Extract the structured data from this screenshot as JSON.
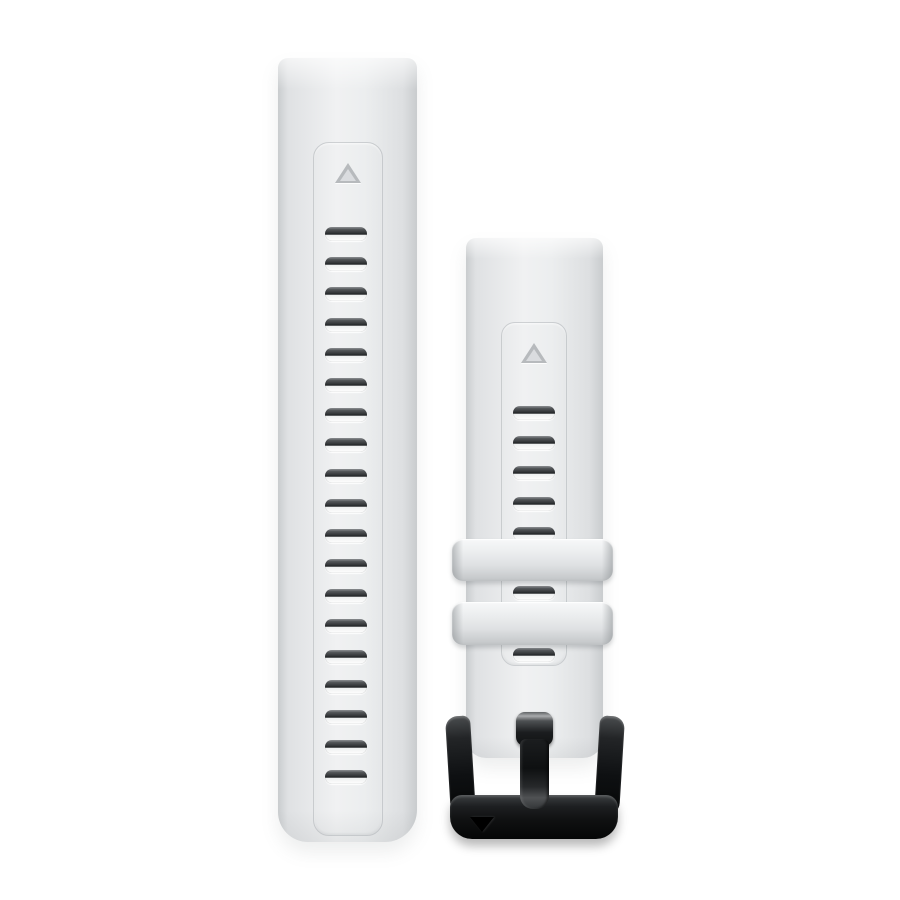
{
  "image": {
    "type": "product-photo",
    "subject": "Quick-release silicone watch band set: long adjustment strap and short strap with black buckle",
    "band_color_name": "whitestone",
    "background_color": "#ffffff"
  },
  "colors": {
    "background": "#ffffff",
    "band": "#e9ebec",
    "band_edge": "#c9ccce",
    "slot_dark": "#212426",
    "slot_light": "#ffffff",
    "marker": "#b7babd",
    "keeper": "#dfe1e3",
    "buckle_black": "#0e1011",
    "buckle_highlight": "#a9abad"
  },
  "long_strap": {
    "adjustment_slots": 19,
    "marker": "triangle-up"
  },
  "short_strap": {
    "slots_above_keepers": 5,
    "slots_between_keepers": 1,
    "slots_below_keepers": 1,
    "keepers": 2,
    "marker": "triangle-up"
  },
  "buckle": {
    "finish": "glossy-black",
    "logo": "triangle-down"
  }
}
